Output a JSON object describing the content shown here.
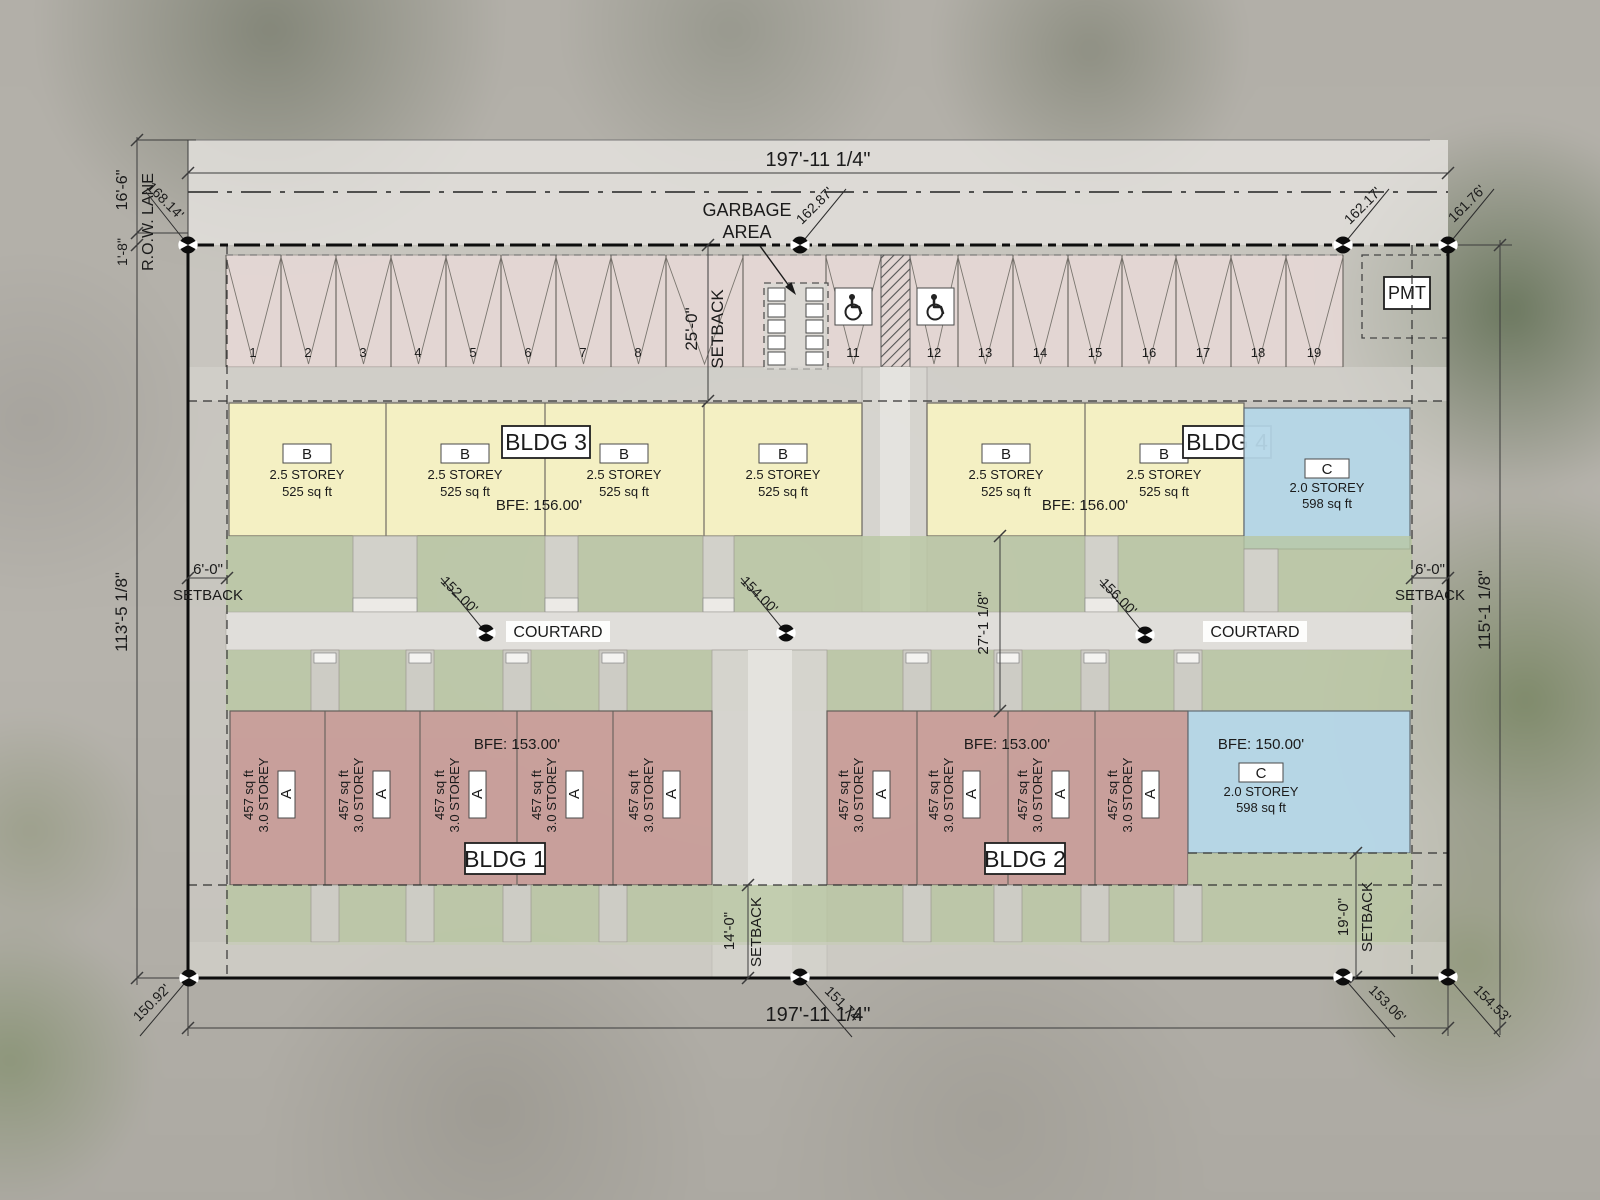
{
  "dimensions": {
    "top_width": "197'-11 1/4\"",
    "bottom_width": "197'-11 1/4\"",
    "left_height": "113'-5 1/8\"",
    "right_height": "115'-1 1/8\"",
    "lane_width": "16'-6\"",
    "lane_offset": "1'-8\"",
    "row_lane": "R.O.W. LANE",
    "courtyard_depth": "27'-1 1/8\""
  },
  "setbacks": {
    "front": {
      "dim": "25'-0\"",
      "label": "SETBACK"
    },
    "left": {
      "dim": "6'-0\"",
      "label": "SETBACK"
    },
    "right": {
      "dim": "6'-0\"",
      "label": "SETBACK"
    },
    "rear_center": {
      "dim": "14'-0\"",
      "label": "SETBACK"
    },
    "rear_right": {
      "dim": "19'-0\"",
      "label": "SETBACK"
    }
  },
  "elevations": {
    "top_left": "168.14'",
    "top_center": "162.87'",
    "top_right": "162.17'",
    "top_corner": "161.76'",
    "mid_left": "152.00'",
    "mid_center": "154.00'",
    "mid_right": "156.00'",
    "bottom_left": "150.92'",
    "bottom_center": "151.74'",
    "bottom_right": "153.06'",
    "bottom_corner": "154.53'"
  },
  "parking": {
    "stalls": [
      "1",
      "2",
      "3",
      "4",
      "5",
      "6",
      "7",
      "8",
      "11",
      "12",
      "13",
      "14",
      "15",
      "16",
      "17",
      "18",
      "19"
    ],
    "garbage_area_line1": "GARBAGE",
    "garbage_area_line2": "AREA",
    "pmt_label": "PMT"
  },
  "courtyard": {
    "left_label": "COURTARD",
    "right_label": "COURTARD"
  },
  "buildings": {
    "bldg1": {
      "label": "BLDG 1",
      "bfe": "BFE: 153.00'"
    },
    "bldg2": {
      "label": "BLDG 2",
      "bfe": "BFE: 153.00'"
    },
    "bldg3": {
      "label": "BLDG 3",
      "bfe": "BFE: 156.00'"
    },
    "bldg4": {
      "label": "BLDG 4",
      "bfe": "BFE: 156.00'"
    },
    "c_bottom": {
      "bfe": "BFE: 150.00'"
    }
  },
  "units": {
    "a": {
      "label": "A",
      "storey": "3.0 STOREY",
      "area": "457 sq ft"
    },
    "b": {
      "label": "B",
      "storey": "2.5 STOREY",
      "area": "525 sq ft"
    },
    "c": {
      "label": "C",
      "storey": "2.0 STOREY",
      "area": "598 sq ft"
    }
  },
  "colors": {
    "unit_a_fill": "#c99e9a",
    "unit_b_fill": "#f7f3c4",
    "unit_c_fill": "#b6d7e8",
    "lawn_fill": "#b9c7a3",
    "paving_fill": "#e2e0dc",
    "parking_fill": "#e9dad8",
    "boundary_line": "#0d0d0d"
  }
}
